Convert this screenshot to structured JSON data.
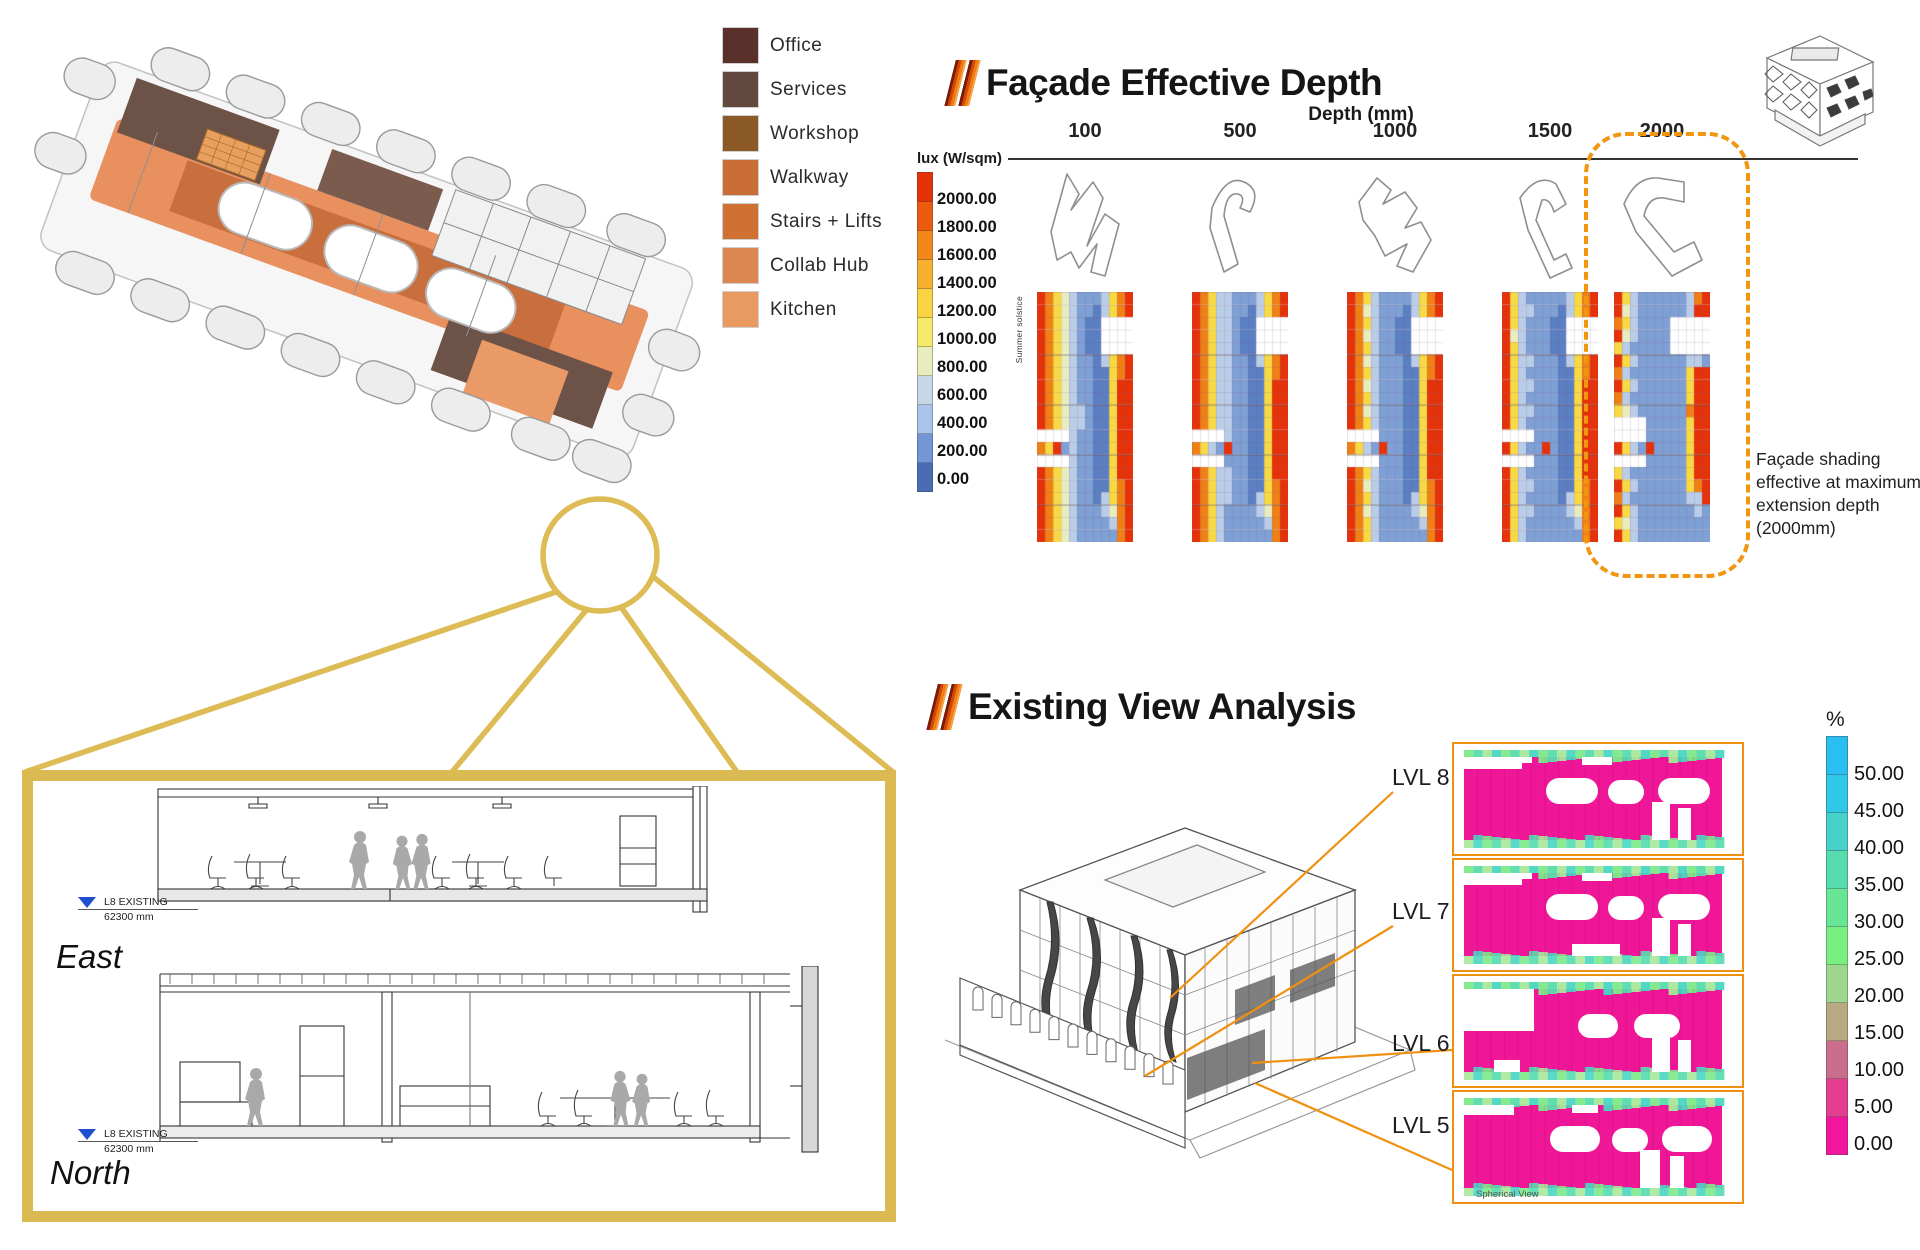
{
  "plan_legend": {
    "items": [
      {
        "label": "Office",
        "color": "#5a312a"
      },
      {
        "label": "Services",
        "color": "#62493e"
      },
      {
        "label": "Workshop",
        "color": "#8c5a26"
      },
      {
        "label": "Walkway",
        "color": "#c86d36"
      },
      {
        "label": "Stairs + Lifts",
        "color": "#cf7133"
      },
      {
        "label": "Collab Hub",
        "color": "#dd8850"
      },
      {
        "label": "Kitchen",
        "color": "#e89a61"
      }
    ]
  },
  "facade_section": {
    "title": "Façade Effective Depth",
    "lux_legend": {
      "title": "lux (W/sqm)",
      "labels": [
        "2000.00",
        "1800.00",
        "1600.00",
        "1400.00",
        "1200.00",
        "1000.00",
        "800.00",
        "600.00",
        "400.00",
        "200.00",
        "0.00"
      ],
      "colors": [
        "#e63209",
        "#ec5b0d",
        "#f2871b",
        "#f6b12e",
        "#f9d343",
        "#f6e969",
        "#e9edbe",
        "#c7d7e6",
        "#a9c3ea",
        "#7396d6",
        "#4a6cb4"
      ]
    },
    "depth_axis": {
      "title": "Depth (mm)",
      "values": [
        "100",
        "500",
        "1000",
        "1500",
        "2000"
      ]
    },
    "summer_label": "Summer solstice",
    "annotation": "Façade shading effective at maximum extension depth (2000mm)",
    "heatmap_palette": {
      "R": "#e63209",
      "O": "#f08015",
      "Y": "#f8d943",
      "P": "#e9edbe",
      "C": "#b9cde8",
      "B": "#7ea0d4",
      "D": "#5a7fc2"
    },
    "heatmaps": [
      {
        "depth": "100",
        "rows": [
          "ROYPCBBBCYOR",
          "ROYPCBBDCYOR",
          "ROYPCBDDWWWW",
          "ROYPCBDDWWWW",
          "ROYPCBDDWWWW",
          "ROYPCBBDCYOR",
          "ROYPCBBDDYOR",
          "ROYPCBBDDYRR",
          "ROYPCBBDDYRR",
          "ROYPCCBDDYRR",
          "ROYPCCBDDYRR",
          "WWWWCBBDDYRR",
          "OYRBCBBDDYRR",
          "WWWWCBBDDYRR",
          "ROYPCBBDDYRR",
          "ROYPCBBDDYOR",
          "ROYPCBBDCYOR",
          "ROYPCBBBCPOR",
          "ROYPCBBBBCOR",
          "ROYPCBBBBBOR"
        ]
      },
      {
        "depth": "500",
        "rows": [
          "ROYCCBBBCYOR",
          "ROYCCBBDCYOR",
          "ROYCCBDDWWWW",
          "ROYCCBDDWWWW",
          "ROYCCBDDWWWW",
          "ROYCCBBDCYOR",
          "ROYCCBBDDYOR",
          "ROYCCBBDDYRR",
          "ROYCCBBDDYRR",
          "ROYCCBBDDYRR",
          "ROYCCBBDDYRR",
          "WWWWCBBDDYRR",
          "OYCBRBBDDYRR",
          "WWWWBBBDDYRR",
          "ROYCCBBDDYRR",
          "ROYCCBBDDYOR",
          "ROYCCBBDCYOR",
          "ROYCBBBBCPOR",
          "ROYCBBBBBCOR",
          "ROYCBBBBBBOR"
        ]
      },
      {
        "depth": "1000",
        "rows": [
          "ROYCBBBBCYOR",
          "ROPCBBBDCYOR",
          "ROYCBBDDWWWW",
          "ROPCBBDDWWWW",
          "ROYCBBDDWWWW",
          "ROPCBBBDCYOR",
          "ROYCBBBDDYOR",
          "ROPCBBBDDYRR",
          "ROYCBBBDDYRR",
          "ROPCBBBDDYRR",
          "ROYCBBBDDYRR",
          "WWWWBBBDDYRR",
          "OYCBRBBDDYRR",
          "WWWWBBBDDYRR",
          "ROYCBBBDDYRR",
          "ROPCBBBDDYOR",
          "ROYCBBBDCYOR",
          "ROPCBBBBCPOR",
          "ROYCBBBBBCOR",
          "ROYCBBBBBBOR"
        ]
      },
      {
        "depth": "1500",
        "rows": [
          "RYCBBBBBCYOR",
          "RYCCBBBDCYOR",
          "RYCBBBDDWWWW",
          "RPCBBBDDWWWW",
          "RYCBBBDDWWWW",
          "RYCCBBBDCYOR",
          "RYCBBBBDDYOR",
          "RYCCBBBDDYRR",
          "RYCBBBBDDYRR",
          "RYCCBBBDDYRR",
          "RYCBBBBDDYRR",
          "WWWWBBBDDYRR",
          "RYCBBRBDDYRR",
          "WWWWBBBDDYRR",
          "RYCBBBBDDYRR",
          "RYCCBBBDDYOR",
          "RYCBBBBDCYOR",
          "RYCCBBBBCPOR",
          "RYCBBBBBBCOR",
          "RYCBBBBBBBOR"
        ]
      },
      {
        "depth": "2000",
        "rows": [
          "RYCBBBBBBCOR",
          "RPCBBBBBBCRR",
          "OYCBBBBWWWWW",
          "RPCBBBBWWWWW",
          "YCBBBBBWWWWW",
          "RYCBBBBBBCCB",
          "OCBBBBBBBYRR",
          "RYCBBBBBBYRR",
          "OCBBBBBBBYRR",
          "YPCBBBBBBORR",
          "WWWWBBBBBYRR",
          "WWWWBBBBBYRR",
          "RYCBRBBBBYRR",
          "WWWWBBBBBYRR",
          "YCBBBBBBBYRR",
          "RYCBBBBBBYOR",
          "OCBBBBBBBCCR",
          "RYCBBBBBBBCB",
          "YPCBBBBBBBBB",
          "RYCBBBBBBBBB"
        ]
      }
    ]
  },
  "view_section": {
    "title": "Existing View Analysis",
    "levels": [
      "LVL 8",
      "LVL 7",
      "LVL 6",
      "LVL 5"
    ],
    "percent_legend": {
      "title": "%",
      "labels": [
        "50.00",
        "45.00",
        "40.00",
        "35.00",
        "30.00",
        "25.00",
        "20.00",
        "15.00",
        "10.00",
        "5.00",
        "0.00"
      ],
      "colors": [
        "#29bff2",
        "#30c8e8",
        "#46d2c8",
        "#57dcae",
        "#68e695",
        "#79ef7f",
        "#9ed58f",
        "#b8ab83",
        "#c96f8d",
        "#e43d92",
        "#f2169e"
      ]
    },
    "spherical_view_label": "Spherical View",
    "heatmap_colors": {
      "main": "#ef1697",
      "green_edge": [
        "#7de989",
        "#57dcae",
        "#a8e89a",
        "#49d6c2"
      ]
    }
  },
  "sections": {
    "east_label": "East",
    "north_label": "North",
    "level_marker": {
      "name": "L8 EXISTING",
      "elevation": "62300 mm"
    }
  },
  "accents": {
    "gold": "#dcba52",
    "orange": "#f09010",
    "dashed_orange": "#f2950f"
  }
}
